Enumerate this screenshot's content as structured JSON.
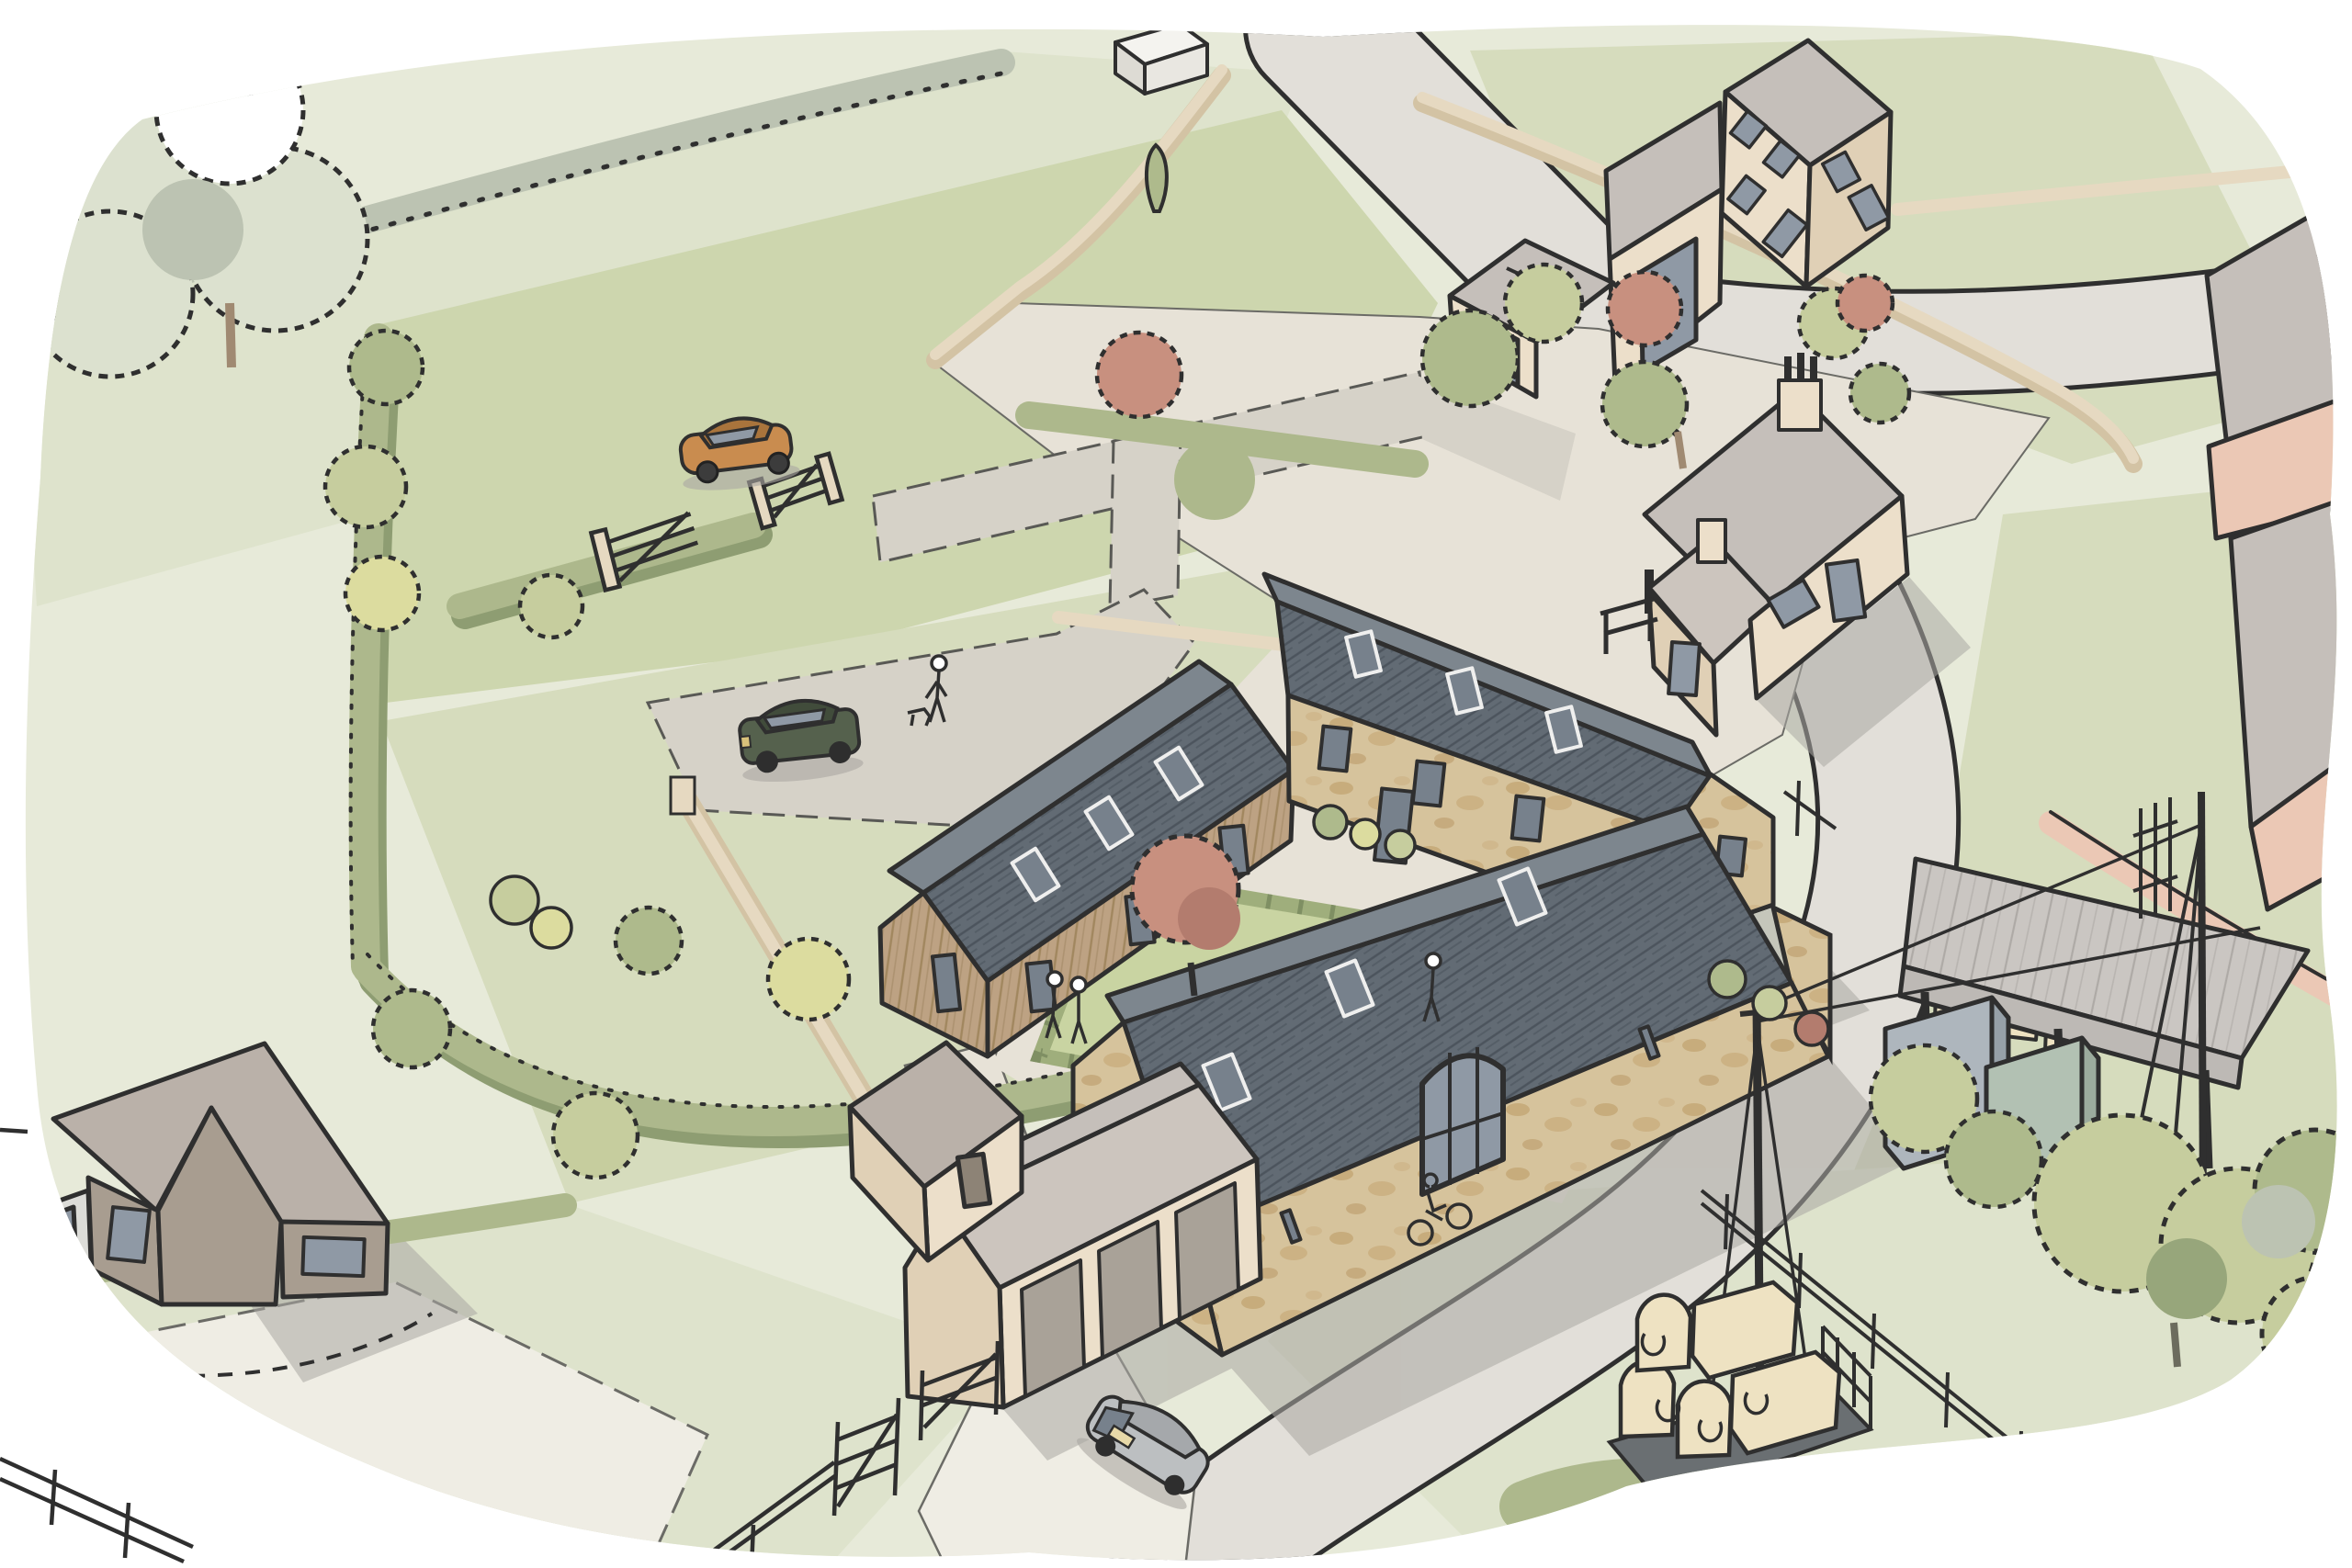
{
  "illustration": {
    "alt": "Aerial hand-drawn architectural sketch of a farmstead barn-conversion: a U-shaped courtyard of stone and timber barns with a lawn and red tree, farmhouse, garage block, bungalow, open hay barn, country road, hedged fields, cars, cyclist, pedestrians and a trailer of hay bales.",
    "objects": {
      "buildings": [
        "courtyard-timber-barn",
        "courtyard-north-stone-barn",
        "courtyard-south-stone-barn",
        "farmhouse",
        "top-house-with-garage",
        "detached-hip-garage",
        "garage-block",
        "small-outbuilding",
        "bungalow",
        "dutch-hay-barn",
        "white-shed",
        "edge-buildings"
      ],
      "vehicles": [
        "orange-car",
        "green-suv",
        "gray-hatchback",
        "hay-trailer"
      ],
      "people": [
        "dog-walker",
        "courtyard-walker",
        "path-couple",
        "cyclist"
      ],
      "landscape": [
        "fields",
        "hedgerows",
        "stone-walls",
        "courtyard-lawn",
        "red-tree",
        "pink-trees",
        "large-trees",
        "roads",
        "driveways",
        "timber-gates",
        "post-and-rail-fence",
        "telegraph-pole",
        "hay-bales",
        "storage-containers"
      ]
    },
    "counts": {
      "hay_bales_on_trailer": 7,
      "cars": 3,
      "timber_gates": 4,
      "courtyard_wings": 3
    }
  },
  "colors": {
    "ink": "#2f2f2f",
    "paper": "#ffffff",
    "baseWash": "#e7ead9",
    "fieldLight": "#dee3cc",
    "fieldMid": "#d6dcbd",
    "fieldGreen": "#cdd6ae",
    "lawn": "#c9d4a2",
    "lawnHedge": "#9fae7c",
    "drive": "#d6d2c8",
    "gravel": "#e7e2d7",
    "road": "#e2dfd9",
    "trackWhite": "#efede4",
    "shadow": "#aaa7a2",
    "hedge": "#adb88c",
    "hedgeShadow": "#8e9d72",
    "treeLight": "#c6cd9e",
    "treeMid": "#aeba8c",
    "treeDark": "#97a67b",
    "treeYellow": "#dcdc9f",
    "treePale": "#dce1cf",
    "treeGrayGreen": "#bcc3b2",
    "treePink": "#c8907f",
    "treePinkDark": "#b37c6e",
    "slate": "#626b74",
    "slateSliver": "#7d868e",
    "roofGray": "#c5bfba",
    "roofWarm": "#ccc5be",
    "corrug": "#cac6c2",
    "stone": "#d6c39c",
    "stoneBlotch": "#bfa06c",
    "timber": "#bda283",
    "cream": "#ecdfca",
    "creamShade": "#e0d0b6",
    "wallTan": "#e6d9c1",
    "wallTanSide": "#d3c3a4",
    "salmon": "#ebc8b5",
    "taupeRoof": "#bab1a9",
    "mocha": "#a89d90",
    "glass": "#8f99a5",
    "glassDark": "#77818c",
    "carOrange": "#c98c4f",
    "carOrangeDark": "#a9743c",
    "suvGreen": "#55614d",
    "suvDark": "#414c3b",
    "carGray": "#bcbfc1",
    "bale": "#eee2c2",
    "containerBlue": "#aeb6bd",
    "containerGreen": "#b2c1b3"
  }
}
